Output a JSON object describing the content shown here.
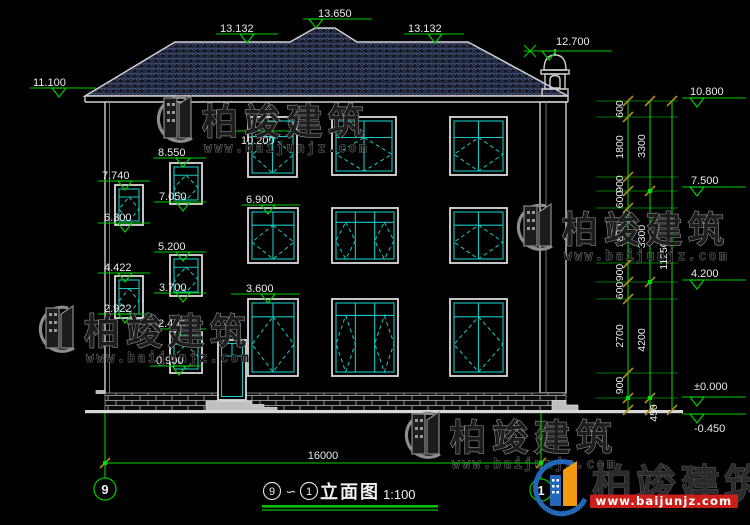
{
  "title": {
    "axis_from": "9",
    "separator": "∽",
    "axis_to": "1",
    "name": "立面图",
    "scale": "1:100"
  },
  "axis_bubbles": {
    "left": "9",
    "right": "1"
  },
  "dimensions": {
    "bottom_total": "16000",
    "right_inner": [
      "600",
      "1800",
      "900",
      "600",
      "1800",
      "900",
      "600",
      "2700",
      "900"
    ],
    "right_middle": [
      "3300",
      "3300",
      "4200",
      "450"
    ],
    "right_total": "11250"
  },
  "elevations": {
    "roof": [
      "11.100",
      "13.132",
      "13.650",
      "13.132",
      "12.700"
    ],
    "right": [
      "10.800",
      "7.500",
      "4.200",
      "±0.000",
      "-0.450"
    ],
    "left": [
      "8.550",
      "7.050",
      "7.740",
      "6.300",
      "5.200",
      "3.700",
      "4.422",
      "2.922",
      "2.400",
      "0.900"
    ],
    "facade": [
      "10.200",
      "6.900",
      "3.600"
    ]
  },
  "watermark": {
    "brand": "柏竣建筑",
    "url": "www.baijunjz.com"
  },
  "logo": {
    "brand": "柏竣建筑",
    "url": "www.baijunjz.com"
  }
}
